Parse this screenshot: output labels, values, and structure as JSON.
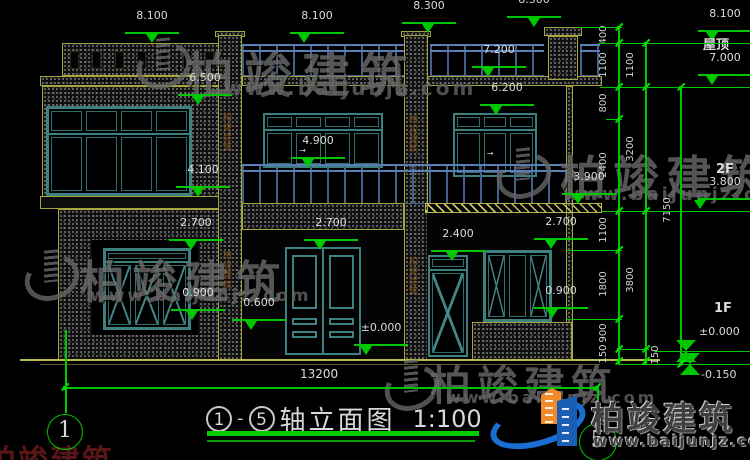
{
  "drawing": {
    "title": {
      "axis_start": "1",
      "axis_end": "5",
      "dash": "-",
      "name": "轴立面图",
      "scale": "1:100"
    },
    "bottom_dim": {
      "value": "13200",
      "x1": 65,
      "x2": 597,
      "y": 387,
      "label_x": 300,
      "label_y": 368
    },
    "axis_bubbles": [
      {
        "n": "1",
        "cx": 64,
        "cy": 431,
        "r": 17
      },
      {
        "n": "5",
        "cx": 597,
        "cy": 441,
        "r": 18
      }
    ],
    "axis_vlines": [
      {
        "x": 65,
        "y1": 330,
        "y2": 413
      },
      {
        "x": 597,
        "y1": 387,
        "y2": 423
      }
    ],
    "elev_markers": [
      {
        "label": "8.100",
        "cx": 152,
        "x": 152,
        "y": 43
      },
      {
        "label": "8.100",
        "cx": 317,
        "x": 304,
        "y": 43
      },
      {
        "label": "8.300",
        "cx": 429,
        "x": 428,
        "y": 33
      },
      {
        "label": "8.500",
        "cx": 534,
        "x": 534,
        "y": 27
      },
      {
        "label": "7.200",
        "cx": 499,
        "x": 488,
        "y": 77
      },
      {
        "label": "6.500",
        "cx": 205,
        "x": 198,
        "y": 105
      },
      {
        "label": "6.200",
        "cx": 507,
        "x": 496,
        "y": 115
      },
      {
        "label": "4.900",
        "cx": 318,
        "x": 308,
        "y": 168
      },
      {
        "label": "4.100",
        "cx": 203,
        "x": 198,
        "y": 197
      },
      {
        "label": "3.900",
        "cx": 589,
        "x": 578,
        "y": 204
      },
      {
        "label": "2.700",
        "cx": 196,
        "x": 191,
        "y": 250
      },
      {
        "label": "2.700",
        "cx": 331,
        "x": 320,
        "y": 250
      },
      {
        "label": "2.400",
        "cx": 458,
        "x": 452,
        "y": 261
      },
      {
        "label": "2.700",
        "cx": 561,
        "x": 551,
        "y": 249
      },
      {
        "label": "0.900",
        "cx": 198,
        "x": 192,
        "y": 320
      },
      {
        "label": "0.600",
        "cx": 259,
        "x": 251,
        "y": 330
      },
      {
        "label": "±0.000",
        "cx": 381,
        "x": 366,
        "y": 355
      },
      {
        "label": "0.900",
        "cx": 561,
        "x": 552,
        "y": 318
      }
    ],
    "right_markers": [
      {
        "label": "8.100",
        "cx": 725,
        "x": 712,
        "y": 41
      },
      {
        "label": "7.000",
        "cx": 725,
        "x": 712,
        "y": 85
      },
      {
        "label": "3.800",
        "cx": 725,
        "x": 700,
        "y": 209
      }
    ],
    "right_texts": [
      {
        "t": "屋顶",
        "x": 703,
        "y": 40,
        "size": 13
      },
      {
        "t": "2F",
        "x": 716,
        "y": 164,
        "size": 13
      },
      {
        "t": "1F",
        "x": 714,
        "y": 303,
        "size": 13
      }
    ],
    "level_markers": [
      {
        "label": "±0.000",
        "lx": 699,
        "ly": 326,
        "x": 686,
        "y": 351,
        "x1": 655,
        "x2": 750
      },
      {
        "label": "-0.150",
        "lx": 701,
        "ly": 369,
        "x": 690,
        "y": 364,
        "x1": 618,
        "x2": 750
      }
    ],
    "dim_chains": [
      {
        "x": 618,
        "y1": 27,
        "y2": 364,
        "lx": 604,
        "ticks": [
          27,
          43,
          87,
          119,
          211,
          250,
          319,
          349,
          361
        ],
        "labels": [
          {
            "v": "400",
            "y": 35
          },
          {
            "v": "1100",
            "y": 65
          },
          {
            "v": "800",
            "y": 103
          },
          {
            "v": "2400",
            "y": 165
          },
          {
            "v": "1100",
            "y": 230
          },
          {
            "v": "1800",
            "y": 284
          },
          {
            "v": "900",
            "y": 333
          },
          {
            "v": "150",
            "y": 354
          }
        ]
      },
      {
        "x": 645,
        "y1": 43,
        "y2": 364,
        "lx": 631,
        "ticks": [
          43,
          87,
          211,
          349,
          361
        ],
        "labels": [
          {
            "v": "1100",
            "y": 65
          },
          {
            "v": "3200",
            "y": 149
          },
          {
            "v": "3800",
            "y": 280
          },
          {
            "v": "150",
            "y": 355,
            "lx": 656
          }
        ]
      },
      {
        "x": 680,
        "y1": 87,
        "y2": 364,
        "lx": 668,
        "ticks": [
          87,
          364
        ],
        "labels": [
          {
            "v": "7150",
            "y": 210
          }
        ]
      }
    ],
    "h_lines": [
      {
        "y": 27,
        "x1": 578,
        "x2": 622
      },
      {
        "y": 43,
        "x1": 598,
        "x2": 750
      },
      {
        "y": 87,
        "x1": 600,
        "x2": 750
      },
      {
        "y": 119,
        "x1": 606,
        "x2": 622
      },
      {
        "y": 211,
        "x1": 602,
        "x2": 750
      },
      {
        "y": 250,
        "x1": 566,
        "x2": 622
      },
      {
        "y": 319,
        "x1": 566,
        "x2": 622
      },
      {
        "y": 349,
        "x1": 618,
        "x2": 649
      }
    ],
    "column_label_text": "柏竣建筑",
    "column_labels": [
      {
        "x": 220,
        "y": 112
      },
      {
        "x": 406,
        "y": 114
      },
      {
        "x": 220,
        "y": 250
      },
      {
        "x": 406,
        "y": 256
      }
    ]
  },
  "watermarks": {
    "name": "柏竣建筑",
    "url": "www.baijunjz.com",
    "corner_text": "柏竣建筑",
    "instances": [
      {
        "x": 186,
        "y": 36,
        "size": 48,
        "spacing": 10,
        "url_x": 224,
        "url_y": 76,
        "url_size": 20,
        "logo_x": 136,
        "logo_y": 36
      },
      {
        "x": 560,
        "y": 142,
        "size": 46,
        "spacing": 7,
        "url_x": 563,
        "url_y": 184,
        "url_size": 18,
        "logo_x": 496,
        "logo_y": 146
      },
      {
        "x": 80,
        "y": 246,
        "size": 45,
        "spacing": 7,
        "url_x": 90,
        "url_y": 286,
        "url_size": 17,
        "logo_x": 24,
        "logo_y": 248
      },
      {
        "x": 430,
        "y": 352,
        "size": 41,
        "spacing": 6,
        "url_x": 446,
        "url_y": 388,
        "url_size": 16,
        "logo_x": 384,
        "logo_y": 358
      }
    ]
  },
  "brand": {
    "name": "柏竣建筑",
    "url": "www.baijunjz.com"
  },
  "colors": {
    "background": "#000000",
    "cad_yellow": "#a6a63e",
    "cad_green": "#00c800",
    "frame_teal": "#3d8080",
    "rail_blue": "#5b7fb5",
    "text_white": "#dcdcdc",
    "watermark_gray": "#6b6b6b",
    "brand_blue": "#1a6fd4",
    "brand_orange": "#f08a2a"
  }
}
